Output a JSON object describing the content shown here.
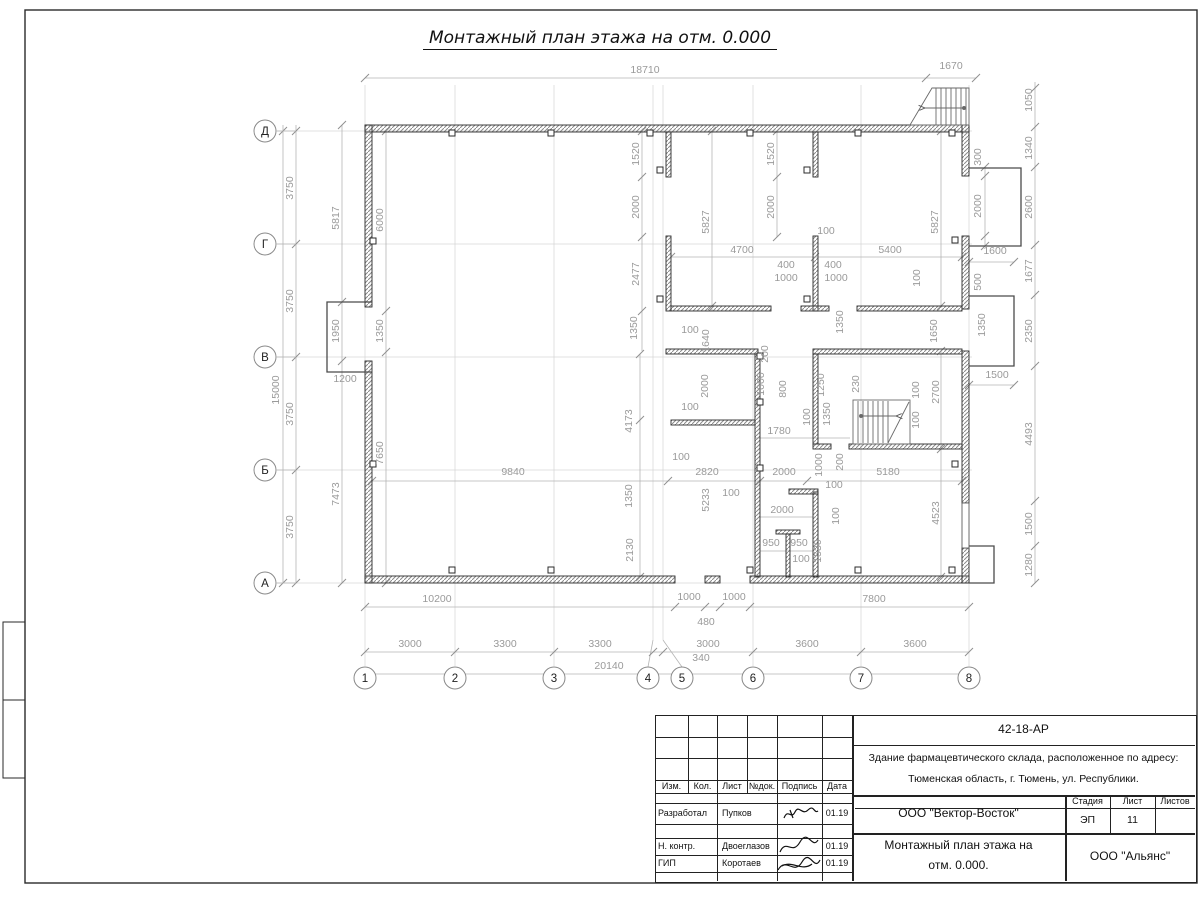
{
  "title": "Монтажный план этажа на отм. 0.000",
  "titleblock": {
    "doc_code": "42-18-АР",
    "object_line1": "Здание фармацевтического склада, расположенное по адресу:",
    "object_line2": "Тюменская область, г. Тюмень, ул. Республики.",
    "org": "ООО \"Вектор-Восток\"",
    "stage_label": "Стадия",
    "sheet_label": "Лист",
    "sheets_label": "Листов",
    "stage": "ЭП",
    "sheet": "11",
    "sheets": "",
    "name_line1": "Монтажный план этажа на",
    "name_line2": "отм. 0.000.",
    "company": "ООО \"Альянс\"",
    "header": {
      "izm": "Изм.",
      "kol": "Кол.",
      "list": "Лист",
      "ndok": "№док.",
      "podpis": "Подпись",
      "data": "Дата"
    },
    "rows": [
      {
        "role": "Разработал",
        "name": "Пупков",
        "date": "01.19"
      },
      {
        "role": "Н. контр.",
        "name": "Двоеглазов",
        "date": "01.19"
      },
      {
        "role": "ГИП",
        "name": "Коротаев",
        "date": "01.19"
      }
    ]
  },
  "plan": {
    "row_axes": [
      {
        "n": "Д",
        "y": 131
      },
      {
        "n": "Г",
        "y": 244
      },
      {
        "n": "В",
        "y": 357
      },
      {
        "n": "Б",
        "y": 470
      },
      {
        "n": "А",
        "y": 583
      }
    ],
    "col_axes": [
      {
        "n": "1",
        "x": 365,
        "cx": 365
      },
      {
        "n": "2",
        "x": 455,
        "cx": 455
      },
      {
        "n": "3",
        "x": 554,
        "cx": 554
      },
      {
        "n": "4",
        "x": 653,
        "cx": 648
      },
      {
        "n": "5",
        "x": 663,
        "cx": 682
      },
      {
        "n": "6",
        "x": 753,
        "cx": 753
      },
      {
        "n": "7",
        "x": 861,
        "cx": 861
      },
      {
        "n": "8",
        "x": 969,
        "cx": 969
      }
    ],
    "dim_labels": [
      {
        "t": "18710",
        "x": 645,
        "y": 73,
        "r": 0
      },
      {
        "t": "1670",
        "x": 951,
        "y": 69,
        "r": 0
      },
      {
        "t": "1050",
        "x": 1032,
        "y": 100,
        "r": 1
      },
      {
        "t": "1340",
        "x": 1032,
        "y": 148,
        "r": 1
      },
      {
        "t": "2600",
        "x": 1032,
        "y": 207,
        "r": 1
      },
      {
        "t": "1677",
        "x": 1032,
        "y": 271,
        "r": 1
      },
      {
        "t": "2350",
        "x": 1032,
        "y": 331,
        "r": 1
      },
      {
        "t": "4493",
        "x": 1032,
        "y": 434,
        "r": 1
      },
      {
        "t": "1500",
        "x": 1032,
        "y": 524,
        "r": 1
      },
      {
        "t": "1280",
        "x": 1032,
        "y": 565,
        "r": 1
      },
      {
        "t": "300",
        "x": 981,
        "y": 157,
        "r": 1
      },
      {
        "t": "2000",
        "x": 981,
        "y": 206,
        "r": 1
      },
      {
        "t": "1600",
        "x": 995,
        "y": 254,
        "r": 0
      },
      {
        "t": "500",
        "x": 981,
        "y": 282,
        "r": 1
      },
      {
        "t": "1350",
        "x": 985,
        "y": 325,
        "r": 1
      },
      {
        "t": "1500",
        "x": 997,
        "y": 378,
        "r": 0
      },
      {
        "t": "3750",
        "x": 293,
        "y": 188,
        "r": 1
      },
      {
        "t": "3750",
        "x": 293,
        "y": 301,
        "r": 1
      },
      {
        "t": "3750",
        "x": 293,
        "y": 414,
        "r": 1
      },
      {
        "t": "3750",
        "x": 293,
        "y": 527,
        "r": 1
      },
      {
        "t": "15000",
        "x": 279,
        "y": 390,
        "r": 1
      },
      {
        "t": "5817",
        "x": 339,
        "y": 218,
        "r": 1
      },
      {
        "t": "1950",
        "x": 339,
        "y": 331,
        "r": 1
      },
      {
        "t": "7473",
        "x": 339,
        "y": 494,
        "r": 1
      },
      {
        "t": "6000",
        "x": 383,
        "y": 220,
        "r": 1
      },
      {
        "t": "1350",
        "x": 383,
        "y": 331,
        "r": 1
      },
      {
        "t": "7650",
        "x": 383,
        "y": 453,
        "r": 1
      },
      {
        "t": "1200",
        "x": 345,
        "y": 382,
        "r": 0
      },
      {
        "t": "1520",
        "x": 639,
        "y": 154,
        "r": 1
      },
      {
        "t": "2000",
        "x": 639,
        "y": 207,
        "r": 1
      },
      {
        "t": "2477",
        "x": 639,
        "y": 274,
        "r": 1
      },
      {
        "t": "5827",
        "x": 709,
        "y": 222,
        "r": 1
      },
      {
        "t": "1520",
        "x": 774,
        "y": 154,
        "r": 1
      },
      {
        "t": "2000",
        "x": 774,
        "y": 207,
        "r": 1
      },
      {
        "t": "5827",
        "x": 938,
        "y": 222,
        "r": 1
      },
      {
        "t": "4700",
        "x": 742,
        "y": 253,
        "r": 0
      },
      {
        "t": "5400",
        "x": 890,
        "y": 253,
        "r": 0
      },
      {
        "t": "100",
        "x": 826,
        "y": 234,
        "r": 0
      },
      {
        "t": "400",
        "x": 786,
        "y": 268,
        "r": 0
      },
      {
        "t": "1000",
        "x": 786,
        "y": 281,
        "r": 0
      },
      {
        "t": "400",
        "x": 833,
        "y": 268,
        "r": 0
      },
      {
        "t": "1000",
        "x": 836,
        "y": 281,
        "r": 0
      },
      {
        "t": "100",
        "x": 920,
        "y": 278,
        "r": 1
      },
      {
        "t": "1350",
        "x": 637,
        "y": 328,
        "r": 1
      },
      {
        "t": "100",
        "x": 690,
        "y": 333,
        "r": 0
      },
      {
        "t": "1640",
        "x": 709,
        "y": 341,
        "r": 1
      },
      {
        "t": "1350",
        "x": 843,
        "y": 322,
        "r": 1
      },
      {
        "t": "1650",
        "x": 937,
        "y": 331,
        "r": 1
      },
      {
        "t": "200",
        "x": 768,
        "y": 354,
        "r": 1
      },
      {
        "t": "1000",
        "x": 764,
        "y": 384,
        "r": 1
      },
      {
        "t": "800",
        "x": 786,
        "y": 389,
        "r": 1
      },
      {
        "t": "2000",
        "x": 708,
        "y": 386,
        "r": 1
      },
      {
        "t": "100",
        "x": 810,
        "y": 417,
        "r": 1
      },
      {
        "t": "1250",
        "x": 824,
        "y": 385,
        "r": 1
      },
      {
        "t": "1350",
        "x": 830,
        "y": 414,
        "r": 1
      },
      {
        "t": "230",
        "x": 859,
        "y": 384,
        "r": 1
      },
      {
        "t": "100",
        "x": 919,
        "y": 390,
        "r": 1
      },
      {
        "t": "100",
        "x": 919,
        "y": 420,
        "r": 1
      },
      {
        "t": "2700",
        "x": 939,
        "y": 392,
        "r": 1
      },
      {
        "t": "4173",
        "x": 632,
        "y": 421,
        "r": 1
      },
      {
        "t": "1780",
        "x": 779,
        "y": 434,
        "r": 0
      },
      {
        "t": "100",
        "x": 690,
        "y": 410,
        "r": 0
      },
      {
        "t": "2820",
        "x": 707,
        "y": 475,
        "r": 0
      },
      {
        "t": "100",
        "x": 681,
        "y": 460,
        "r": 0
      },
      {
        "t": "2000",
        "x": 784,
        "y": 475,
        "r": 0
      },
      {
        "t": "5180",
        "x": 888,
        "y": 475,
        "r": 0
      },
      {
        "t": "9840",
        "x": 513,
        "y": 475,
        "r": 0
      },
      {
        "t": "1350",
        "x": 632,
        "y": 496,
        "r": 1
      },
      {
        "t": "2130",
        "x": 633,
        "y": 550,
        "r": 1
      },
      {
        "t": "5233",
        "x": 709,
        "y": 500,
        "r": 1
      },
      {
        "t": "100",
        "x": 731,
        "y": 496,
        "r": 0
      },
      {
        "t": "2000",
        "x": 782,
        "y": 513,
        "r": 0
      },
      {
        "t": "100",
        "x": 839,
        "y": 516,
        "r": 1
      },
      {
        "t": "1000",
        "x": 822,
        "y": 465,
        "r": 1
      },
      {
        "t": "200",
        "x": 843,
        "y": 462,
        "r": 1
      },
      {
        "t": "100",
        "x": 834,
        "y": 488,
        "r": 0
      },
      {
        "t": "950",
        "x": 771,
        "y": 546,
        "r": 0
      },
      {
        "t": "950",
        "x": 799,
        "y": 546,
        "r": 0
      },
      {
        "t": "100",
        "x": 801,
        "y": 562,
        "r": 0
      },
      {
        "t": "1530",
        "x": 821,
        "y": 551,
        "r": 1
      },
      {
        "t": "4523",
        "x": 939,
        "y": 513,
        "r": 1
      },
      {
        "t": "10200",
        "x": 437,
        "y": 602,
        "r": 0
      },
      {
        "t": "1000",
        "x": 689,
        "y": 600,
        "r": 0
      },
      {
        "t": "1000",
        "x": 734,
        "y": 600,
        "r": 0
      },
      {
        "t": "480",
        "x": 706,
        "y": 625,
        "r": 0
      },
      {
        "t": "340",
        "x": 701,
        "y": 661,
        "r": 0
      },
      {
        "t": "7800",
        "x": 874,
        "y": 602,
        "r": 0
      },
      {
        "t": "3000",
        "x": 410,
        "y": 647,
        "r": 0
      },
      {
        "t": "3300",
        "x": 505,
        "y": 647,
        "r": 0
      },
      {
        "t": "3300",
        "x": 600,
        "y": 647,
        "r": 0
      },
      {
        "t": "3000",
        "x": 708,
        "y": 647,
        "r": 0
      },
      {
        "t": "3600",
        "x": 807,
        "y": 647,
        "r": 0
      },
      {
        "t": "3600",
        "x": 915,
        "y": 647,
        "r": 0
      },
      {
        "t": "20140",
        "x": 609,
        "y": 669,
        "r": 0
      }
    ]
  }
}
